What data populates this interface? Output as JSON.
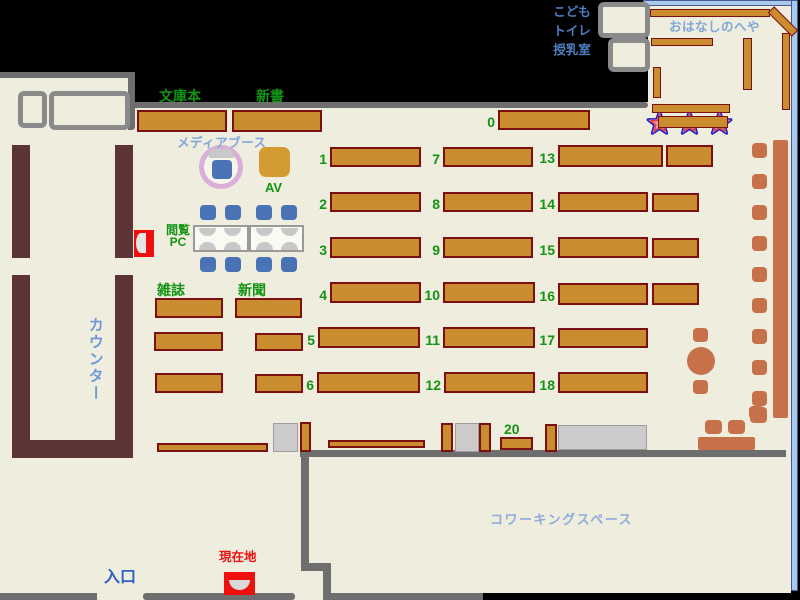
{
  "map": {
    "labels": {
      "kids_toilet_nursing": "こども\nトイレ\n授乳室",
      "story_room": "おはなしのへや",
      "paperback": "文庫本",
      "new_books": "新書",
      "media_booth": "メディアブース",
      "av": "AV",
      "browsing_pc": "閲覧\nPC",
      "magazines": "雑誌",
      "newspapers": "新聞",
      "counter": "カウンター",
      "current_location": "現在地",
      "entrance": "入口",
      "coworking": "コワーキングスペース"
    },
    "colors": {
      "background": "#000000",
      "floor": "#eeedde",
      "wall_gray": "#6e6e6e",
      "shelf_fill": "#c98c2e",
      "shelf_border": "#7c1010",
      "counter_brown": "#5c3436",
      "terracotta": "#c7714a",
      "chair_blue": "#4a73b5",
      "label_green": "#149414",
      "label_light_blue": "#7fa6d9",
      "label_blue": "#2e5fc9",
      "label_mid_blue": "#4e7fc4",
      "label_red": "#ee1111",
      "window_blue": "#a9c9e9",
      "media_ring_pink": "#d9aed9",
      "av_orange": "#d49b32",
      "star_outline_blue": "#1a1acc",
      "star_fill_pink": "#f29d9d",
      "gray_box": "#cbcbcb",
      "gate_red": "#ee0f0f"
    },
    "numbered_shelves": [
      {
        "n": "0",
        "x": 498,
        "y": 110,
        "w": 92,
        "h": 20
      },
      {
        "n": "1",
        "x": 330,
        "y": 147,
        "w": 91,
        "h": 20
      },
      {
        "n": "2",
        "x": 330,
        "y": 192,
        "w": 91,
        "h": 20
      },
      {
        "n": "3",
        "x": 330,
        "y": 237,
        "w": 91,
        "h": 21
      },
      {
        "n": "4",
        "x": 330,
        "y": 282,
        "w": 91,
        "h": 21
      },
      {
        "n": "5",
        "x": 318,
        "y": 327,
        "w": 102,
        "h": 21
      },
      {
        "n": "6",
        "x": 317,
        "y": 372,
        "w": 103,
        "h": 21
      },
      {
        "n": "7",
        "x": 443,
        "y": 147,
        "w": 90,
        "h": 20
      },
      {
        "n": "8",
        "x": 443,
        "y": 192,
        "w": 90,
        "h": 20
      },
      {
        "n": "9",
        "x": 443,
        "y": 237,
        "w": 90,
        "h": 21
      },
      {
        "n": "10",
        "x": 443,
        "y": 282,
        "w": 92,
        "h": 21
      },
      {
        "n": "11",
        "x": 443,
        "y": 327,
        "w": 92,
        "h": 21
      },
      {
        "n": "12",
        "x": 444,
        "y": 372,
        "w": 91,
        "h": 21
      },
      {
        "n": "13",
        "x": 558,
        "y": 145,
        "w": 105,
        "h": 22
      },
      {
        "n": "14",
        "x": 558,
        "y": 192,
        "w": 90,
        "h": 20
      },
      {
        "n": "15",
        "x": 558,
        "y": 237,
        "w": 90,
        "h": 21
      },
      {
        "n": "16",
        "x": 558,
        "y": 283,
        "w": 90,
        "h": 22
      },
      {
        "n": "17",
        "x": 558,
        "y": 328,
        "w": 90,
        "h": 20
      },
      {
        "n": "18",
        "x": 558,
        "y": 372,
        "w": 90,
        "h": 21
      },
      {
        "n": "20",
        "x": 500,
        "y": 437,
        "w": 33,
        "h": 13,
        "labelPos": "top"
      }
    ],
    "plain_shelves": [
      {
        "x": 137,
        "y": 110,
        "w": 90,
        "h": 22
      },
      {
        "x": 232,
        "y": 110,
        "w": 90,
        "h": 22
      },
      {
        "x": 666,
        "y": 145,
        "w": 47,
        "h": 22
      },
      {
        "x": 652,
        "y": 193,
        "w": 47,
        "h": 19
      },
      {
        "x": 652,
        "y": 238,
        "w": 47,
        "h": 20
      },
      {
        "x": 652,
        "y": 283,
        "w": 47,
        "h": 22
      },
      {
        "x": 155,
        "y": 298,
        "w": 68,
        "h": 20
      },
      {
        "x": 235,
        "y": 298,
        "w": 67,
        "h": 20
      },
      {
        "x": 154,
        "y": 332,
        "w": 69,
        "h": 19
      },
      {
        "x": 255,
        "y": 333,
        "w": 48,
        "h": 18
      },
      {
        "x": 155,
        "y": 373,
        "w": 68,
        "h": 20
      },
      {
        "x": 255,
        "y": 374,
        "w": 48,
        "h": 19
      },
      {
        "x": 157,
        "y": 443,
        "w": 111,
        "h": 9
      },
      {
        "x": 328,
        "y": 440,
        "w": 97,
        "h": 8
      },
      {
        "x": 300,
        "y": 422,
        "w": 11,
        "h": 30
      },
      {
        "x": 441,
        "y": 423,
        "w": 12,
        "h": 29
      },
      {
        "x": 479,
        "y": 423,
        "w": 12,
        "h": 29
      },
      {
        "x": 545,
        "y": 424,
        "w": 12,
        "h": 28
      }
    ],
    "story_room_shelves": [
      {
        "x": 650,
        "y": 9,
        "w": 120,
        "h": 8
      },
      {
        "x": 766,
        "y": 17,
        "w": 34,
        "h": 9,
        "rot": 45
      },
      {
        "x": 782,
        "y": 33,
        "w": 8,
        "h": 77
      },
      {
        "x": 651,
        "y": 38,
        "w": 62,
        "h": 8
      },
      {
        "x": 743,
        "y": 38,
        "w": 9,
        "h": 52
      },
      {
        "x": 653,
        "y": 67,
        "w": 8,
        "h": 31
      },
      {
        "x": 652,
        "y": 104,
        "w": 78,
        "h": 9
      },
      {
        "x": 658,
        "y": 116,
        "w": 70,
        "h": 12
      }
    ],
    "gray_boxes": [
      {
        "x": 273,
        "y": 423,
        "w": 25,
        "h": 29
      },
      {
        "x": 455,
        "y": 423,
        "w": 24,
        "h": 29
      },
      {
        "x": 558,
        "y": 425,
        "w": 89,
        "h": 25
      }
    ],
    "counter_parts": [
      {
        "x": 12,
        "y": 145,
        "w": 18,
        "h": 113
      },
      {
        "x": 115,
        "y": 145,
        "w": 18,
        "h": 113
      },
      {
        "x": 12,
        "y": 275,
        "w": 18,
        "h": 183
      },
      {
        "x": 115,
        "y": 275,
        "w": 18,
        "h": 183
      },
      {
        "x": 12,
        "y": 440,
        "w": 121,
        "h": 18
      }
    ],
    "gray_border_rooms": [
      {
        "x": 18,
        "y": 91,
        "w": 29,
        "h": 37
      },
      {
        "x": 49,
        "y": 91,
        "w": 81,
        "h": 39
      },
      {
        "x": 598,
        "y": 2,
        "w": 52,
        "h": 36
      },
      {
        "x": 608,
        "y": 38,
        "w": 42,
        "h": 34
      }
    ],
    "blue_chairs": [
      {
        "x": 200,
        "y": 205,
        "w": 16,
        "h": 15
      },
      {
        "x": 225,
        "y": 205,
        "w": 16,
        "h": 15
      },
      {
        "x": 256,
        "y": 205,
        "w": 16,
        "h": 15
      },
      {
        "x": 281,
        "y": 205,
        "w": 16,
        "h": 15
      },
      {
        "x": 200,
        "y": 257,
        "w": 16,
        "h": 15
      },
      {
        "x": 225,
        "y": 257,
        "w": 16,
        "h": 15
      },
      {
        "x": 256,
        "y": 257,
        "w": 16,
        "h": 15
      },
      {
        "x": 281,
        "y": 257,
        "w": 16,
        "h": 15
      },
      {
        "x": 212,
        "y": 160,
        "w": 20,
        "h": 19
      }
    ],
    "pc_monitors": [
      {
        "x": 199,
        "y": 228,
        "dir": "down"
      },
      {
        "x": 224,
        "y": 228,
        "dir": "down"
      },
      {
        "x": 256,
        "y": 228,
        "dir": "down"
      },
      {
        "x": 281,
        "y": 228,
        "dir": "down"
      },
      {
        "x": 199,
        "y": 242,
        "dir": "up"
      },
      {
        "x": 224,
        "y": 242,
        "dir": "up"
      },
      {
        "x": 256,
        "y": 242,
        "dir": "up"
      },
      {
        "x": 281,
        "y": 242,
        "dir": "up"
      }
    ],
    "right_stool_ys": [
      143,
      174,
      205,
      236,
      267,
      298,
      329,
      360,
      391
    ],
    "right_stool_x": 752,
    "terracotta_rects": [
      {
        "x": 773,
        "y": 140,
        "w": 15,
        "h": 278,
        "flat": true
      },
      {
        "x": 698,
        "y": 437,
        "w": 57,
        "h": 13,
        "flat": true
      },
      {
        "x": 693,
        "y": 328,
        "w": 15,
        "h": 14
      },
      {
        "x": 693,
        "y": 380,
        "w": 15,
        "h": 14
      },
      {
        "x": 750,
        "y": 407,
        "w": 17,
        "h": 16
      },
      {
        "x": 705,
        "y": 420,
        "w": 17,
        "h": 14
      },
      {
        "x": 728,
        "y": 420,
        "w": 17,
        "h": 14
      },
      {
        "x": 749,
        "y": 406,
        "w": 15,
        "h": 13
      }
    ],
    "terracotta_circles": [
      {
        "x": 687,
        "y": 347,
        "d": 28
      }
    ]
  }
}
